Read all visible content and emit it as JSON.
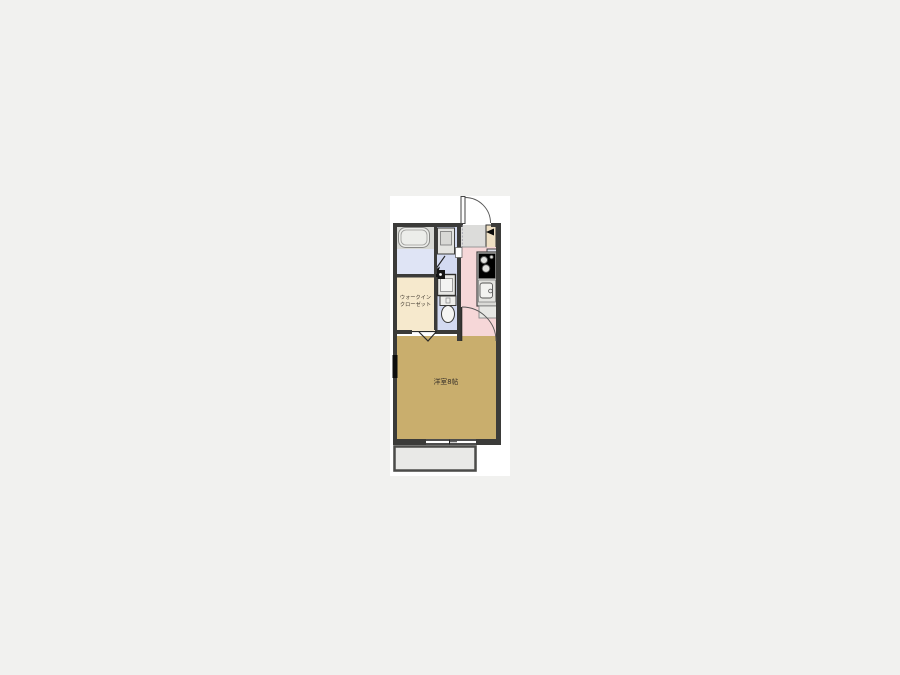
{
  "floor_plan": {
    "labels": {
      "walk_in_closet_line1": "ウォークイン",
      "walk_in_closet_line2": "クローゼット",
      "main_room": "洋室8帖"
    },
    "colors": {
      "background": "#f1f1ef",
      "panel": "#ffffff",
      "wall": "#3b3b39",
      "wall_window": "#0d0d0d",
      "bathroom_floor": "#dfe4f5",
      "bathroom_tile": "#d8d9d5",
      "washroom_floor": "#d3daf1",
      "kitchen_floor": "#f6d7d8",
      "closet_floor": "#f6e9cd",
      "main_room_floor": "#c9ae6d",
      "entrance_floor": "#dcdcda",
      "entrance_side": "#eedfc3",
      "balcony_floor": "#e9e9e7",
      "balcony_wall": "#4c4c4a",
      "fixture_fill": "#e7e7e4",
      "label_text": "#3a332a"
    }
  }
}
